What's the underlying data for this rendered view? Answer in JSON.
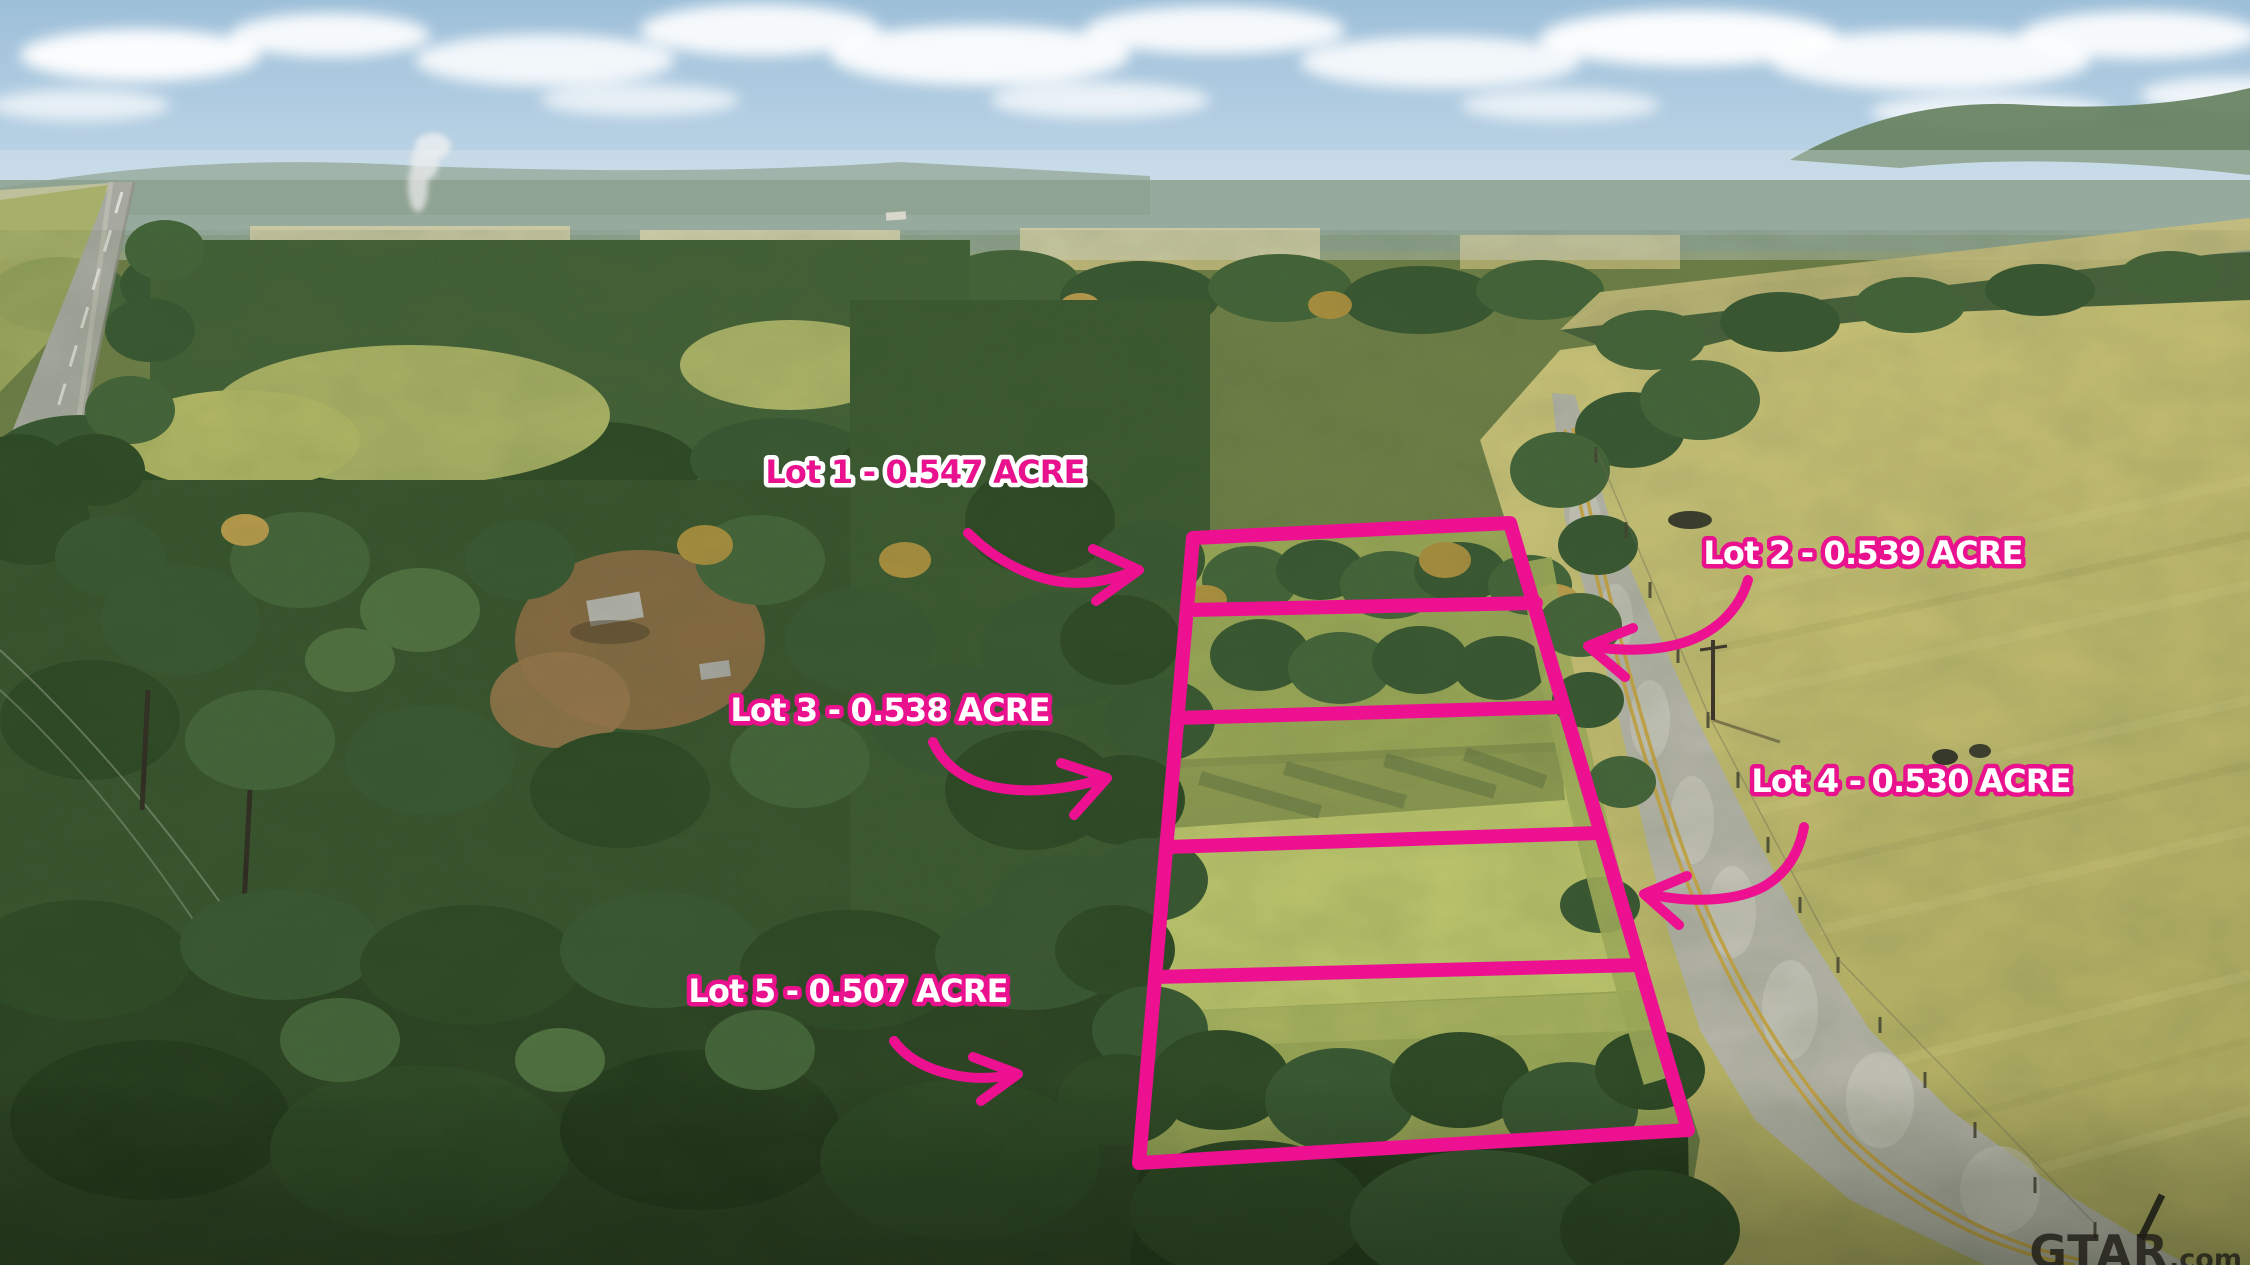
{
  "scene": {
    "type": "aerial-drone-photograph",
    "subject": "Five surveyed land lots outlined in pink beside a rural road, surrounded by forest, fields and a highway"
  },
  "palette": {
    "annotation_pink": "#ED1191",
    "label_white": "#FFFFFF",
    "sky_blue": "#9DBFD9",
    "field_tan": "#C8C173",
    "forest_green": "#375631",
    "road_gray": "#B6B5AA"
  },
  "annotations": {
    "boundary_lot_count": 5,
    "labels": [
      {
        "id": "lot-1",
        "text": "Lot 1 - 0.547 ACRE",
        "style": "pink-text-white-outline"
      },
      {
        "id": "lot-2",
        "text": "Lot 2 - 0.539 ACRE",
        "style": "white-text-pink-outline"
      },
      {
        "id": "lot-3",
        "text": "Lot 3 - 0.538 ACRE",
        "style": "white-text-pink-outline"
      },
      {
        "id": "lot-4",
        "text": "Lot 4 - 0.530 ACRE",
        "style": "white-text-pink-outline"
      },
      {
        "id": "lot-5",
        "text": "Lot 5 - 0.507 ACRE",
        "style": "white-text-pink-outline"
      }
    ],
    "arrows": [
      "lot-1-arrow",
      "lot-2-arrow",
      "lot-3-arrow",
      "lot-4-arrow",
      "lot-5-arrow"
    ]
  },
  "watermark": {
    "brand": "GTAR",
    "suffix": ".com"
  }
}
